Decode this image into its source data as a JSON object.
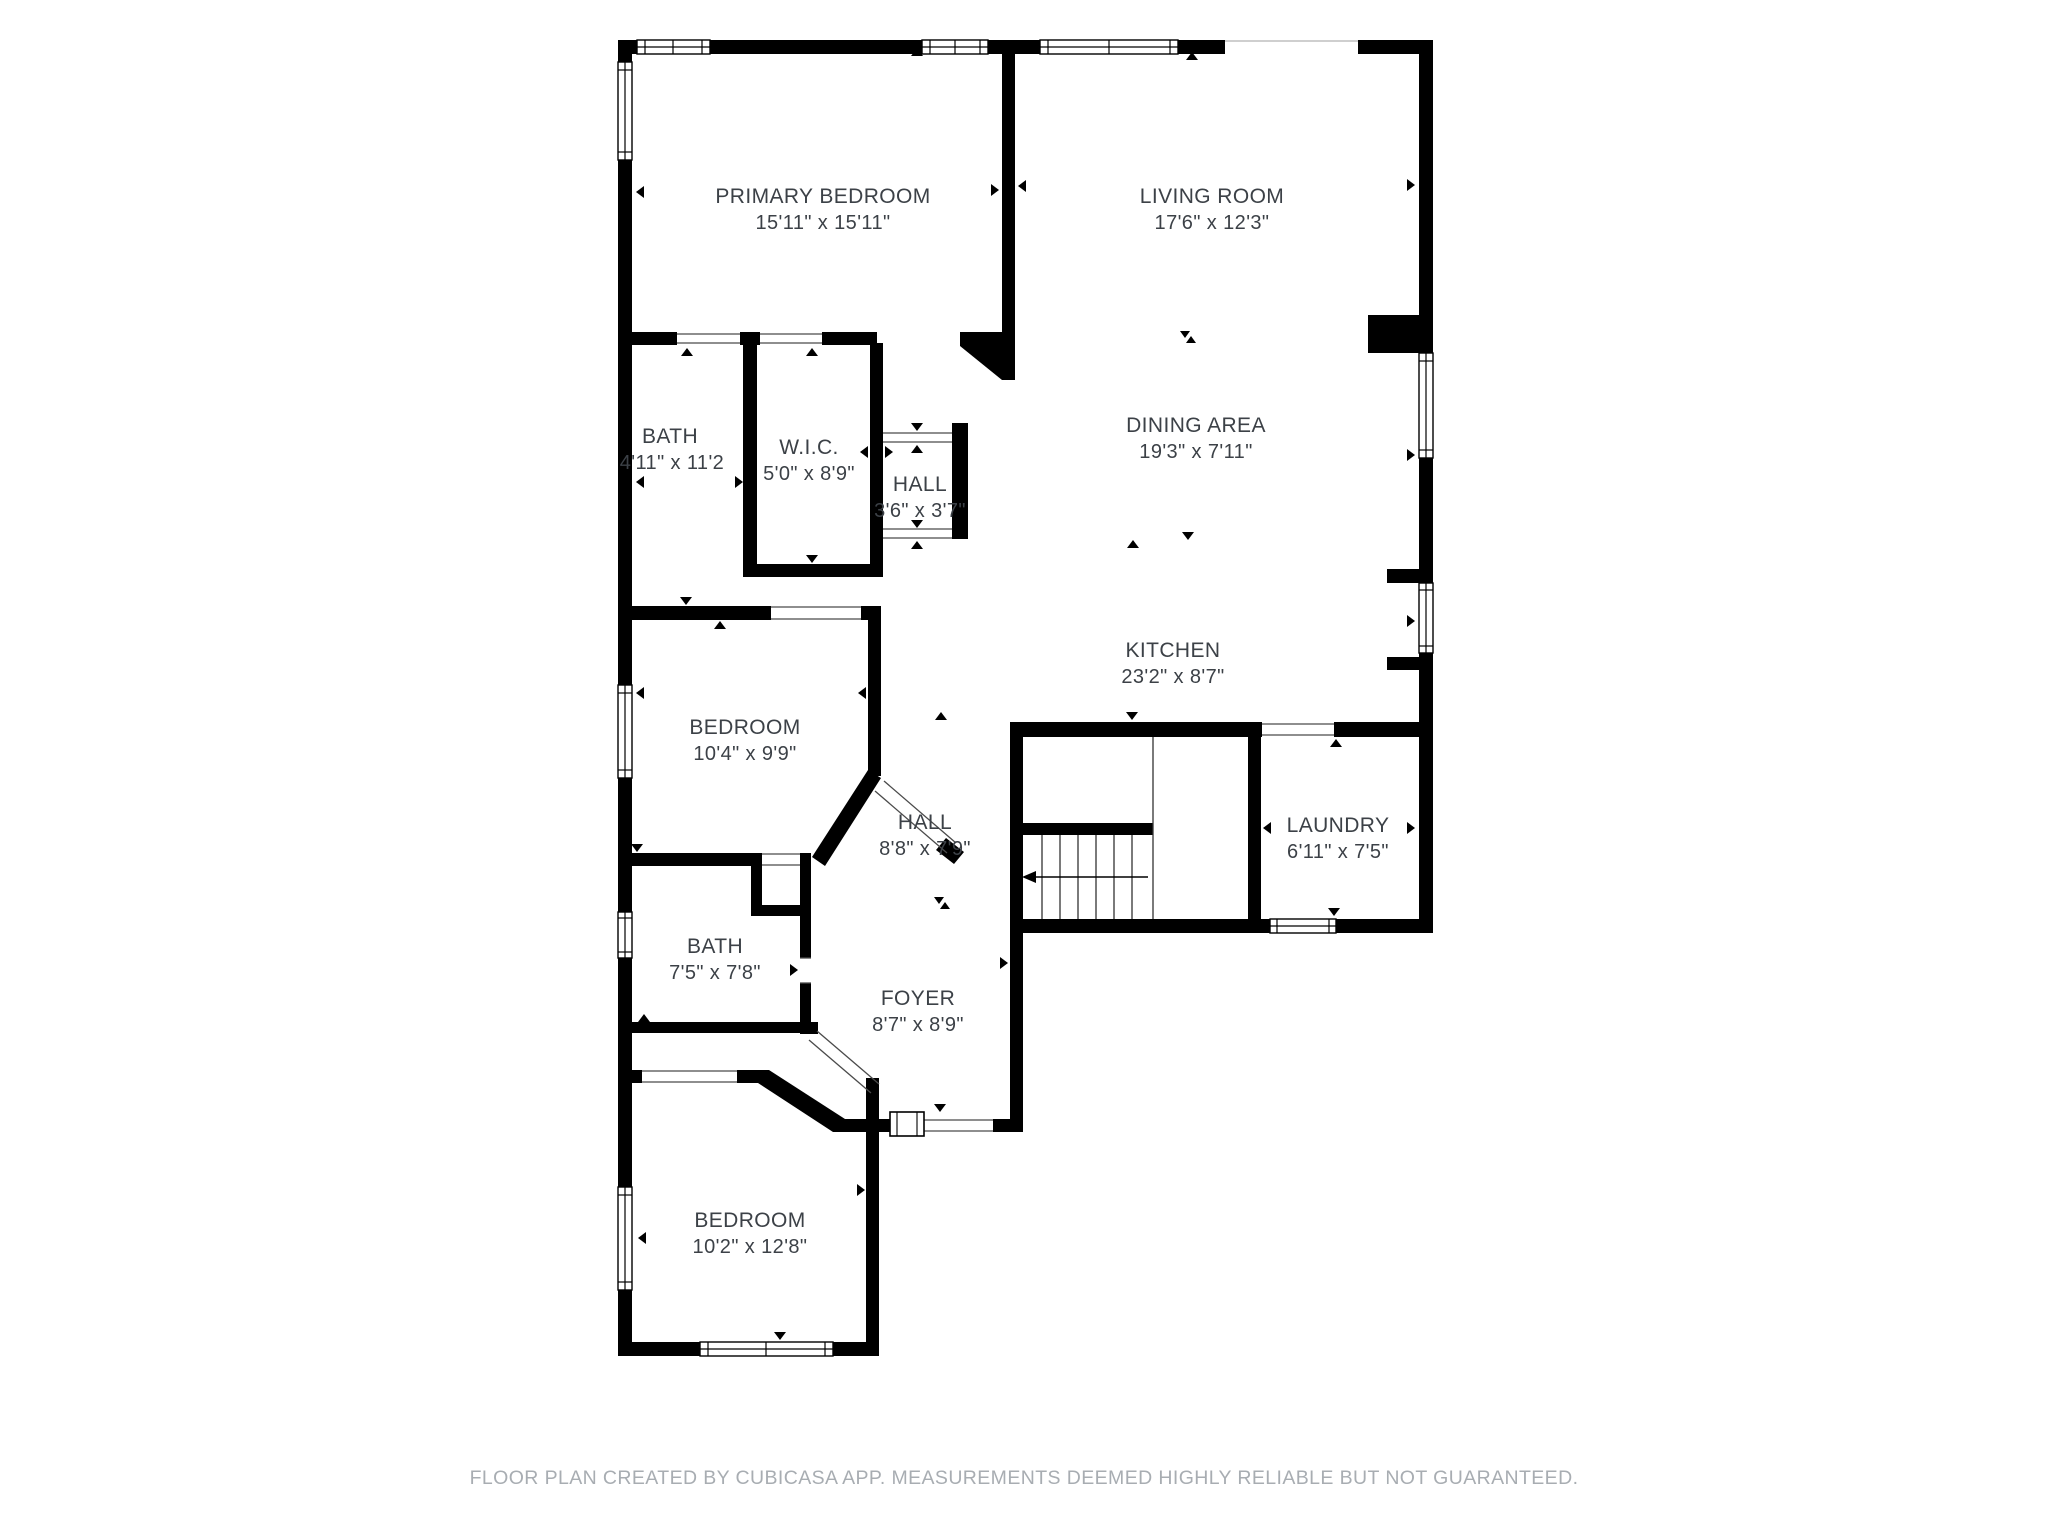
{
  "plan": {
    "type": "residential-floor-plan",
    "creator_note_visible": true
  },
  "palette": {
    "wall_color": "#000000",
    "floor_color": "#ffffff",
    "label_color": "#3c4147",
    "footer_color": "#a8adb2",
    "opening_line_color": "#4a4a4a"
  },
  "rooms": {
    "primary_bedroom": {
      "name": "PRIMARY BEDROOM",
      "dims": "15'11\" x 15'11\""
    },
    "living_room": {
      "name": "LIVING ROOM",
      "dims": "17'6\" x 12'3\""
    },
    "bath_upper": {
      "name": "BATH",
      "dims": "4'11\" x 11'2"
    },
    "wic": {
      "name": "W.I.C.",
      "dims": "5'0\" x 8'9\""
    },
    "hall_small": {
      "name": "HALL",
      "dims": "3'6\" x 3'7\""
    },
    "dining_area": {
      "name": "DINING AREA",
      "dims": "19'3\" x 7'11\""
    },
    "kitchen": {
      "name": "KITCHEN",
      "dims": "23'2\" x 8'7\""
    },
    "bedroom_middle": {
      "name": "BEDROOM",
      "dims": "10'4\" x 9'9\""
    },
    "hall_main": {
      "name": "HALL",
      "dims": "8'8\" x 7'9\""
    },
    "laundry": {
      "name": "LAUNDRY",
      "dims": "6'11\" x 7'5\""
    },
    "bath_lower": {
      "name": "BATH",
      "dims": "7'5\" x 7'8\""
    },
    "foyer": {
      "name": "FOYER",
      "dims": "8'7\" x 8'9\""
    },
    "bedroom_bottom": {
      "name": "BEDROOM",
      "dims": "10'2\" x 12'8\""
    }
  },
  "footer": {
    "text": "FLOOR PLAN CREATED BY CUBICASA APP. MEASUREMENTS DEEMED HIGHLY RELIABLE BUT NOT GUARANTEED."
  }
}
